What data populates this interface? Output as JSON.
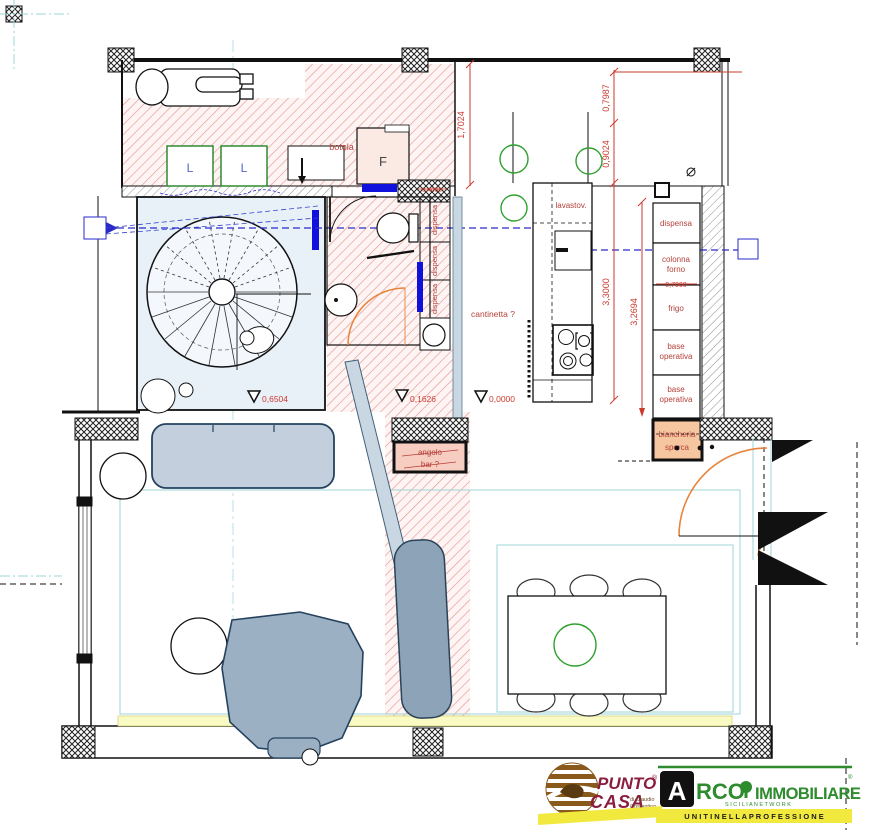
{
  "plan": {
    "labels": {
      "botola": "botola 120x120",
      "f": "F",
      "l": "L",
      "lavastov": "lavastov.",
      "dispensa": "dispensa",
      "colonna_1": "colonna",
      "colonna_2": "forno",
      "frigo": "frigo",
      "base_1": "base",
      "base_2": "operativa",
      "biancheria_1": "biancheria",
      "biancheria_2": "sporca",
      "cantinetta": "cantinetta ?",
      "angolo_1": "angolo",
      "angolo_2": "bar ?"
    },
    "dimensions": {
      "d17024": "1,7024",
      "d07987": "0,7987",
      "d09024": "0,9024",
      "d33000": "3,3000",
      "d32694": "3,2694",
      "d07000": "0,7000",
      "d04000": "0,4000"
    },
    "levels": {
      "l1": "0,6504",
      "l2": "0,1626",
      "l3": "0,0000"
    }
  },
  "logos": {
    "punto_casa": {
      "line1": "PUNTO",
      "reg": "®",
      "line2": "CASA",
      "sub1": "di Claudio",
      "sub2": "Costantino"
    },
    "arco": {
      "a": "A",
      "rco": "RCO",
      "immobiliare": "IMMOBILIARE",
      "reg": "®",
      "sicilia": "S I C I L I A     N E T W O R K",
      "banner": "U N I T I   N E L L A   P R O F E S S I O N E"
    }
  },
  "colors": {
    "dim_red": "#cc3a2e",
    "label_red": "#b5413a",
    "hatch_red": "#e39b94",
    "marker_blue": "#1111dd",
    "section_blue": "#2a2ac8",
    "green": "#2fa02f",
    "orange": "#e8833a",
    "teal": "#9fd4d4",
    "sofa_fill": "#c3cfdc",
    "maroon": "#8b1d3f",
    "logo_green": "#2e8b2e",
    "banner_yellow": "#f2e93f"
  }
}
